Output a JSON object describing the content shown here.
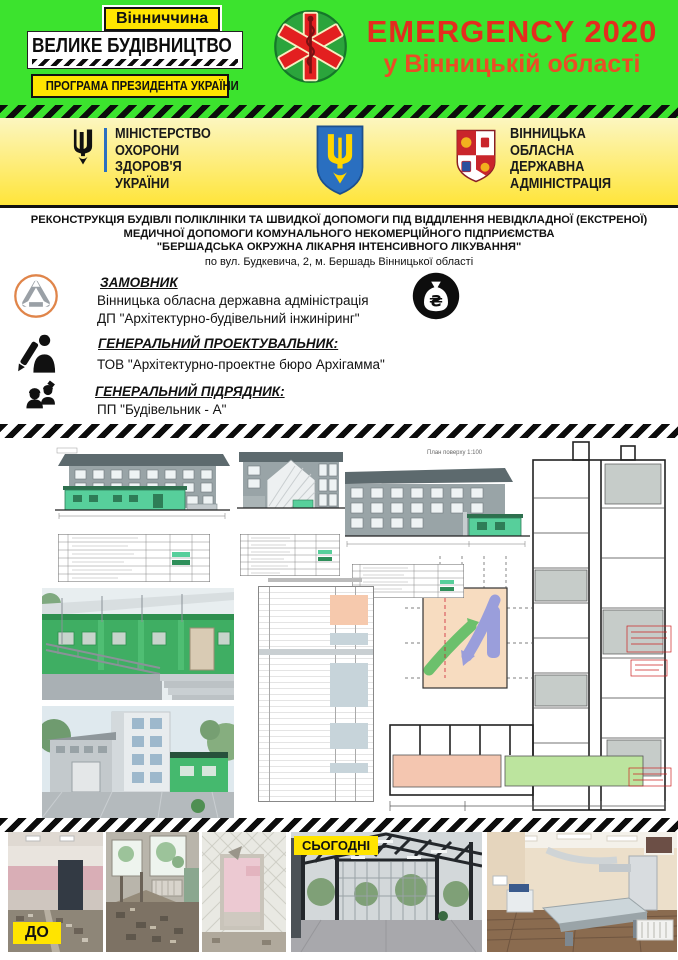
{
  "header": {
    "region_badge": "Вінниччина",
    "program_title": "ВЕЛИКЕ БУДІВНИЦТВО",
    "program_subtitle": "ПРОГРАМА ПРЕЗИДЕНТА УКРАЇНИ",
    "emergency_title": "EMERGENCY 2020",
    "emergency_subtitle": "у Вінницькій області",
    "colors": {
      "bg_green": "#3ce32e",
      "emergency_red": "#e42d1e",
      "badge_yellow": "#ffe400"
    }
  },
  "logos": {
    "moh_lines": [
      "МІНІСТЕРСТВО",
      "ОХОРОНИ",
      "ЗДОРОВ'Я",
      "УКРАЇНИ"
    ],
    "oda_lines": [
      "ВІННИЦЬКА",
      "ОБЛАСНА",
      "ДЕРЖАВНА",
      "АДМІНІСТРАЦІЯ"
    ]
  },
  "project_title": {
    "line1": "РЕКОНСТРУКЦІЯ БУДІВЛІ ПОЛІКЛІНІКИ ТА ШВИДКОЇ ДОПОМОГИ ПІД ВІДДІЛЕННЯ НЕВІДКЛАДНОЇ (ЕКСТРЕНОЇ)",
    "line2": "МЕДИЧНОЇ ДОПОМОГИ КОМУНАЛЬНОГО НЕКОМЕРЦІЙНОГО ПІДПРИЄМСТВА",
    "line3": "\"БЕРШАДСЬКА ОКРУЖНА ЛІКАРНЯ ІНТЕНСИВНОГО ЛІКУВАННЯ\"",
    "line4": "по вул. Будкевича, 2,  м. Бершадь Вінницької області"
  },
  "parties": {
    "customer_label": "ЗАМОВНИК",
    "customer_line1": "Вінницька обласна державна адміністрація",
    "customer_line2": "ДП \"Архітектурно-будівельний інжиніринг\"",
    "designer_label": "ГЕНЕРАЛЬНИЙ ПРОЕКТУВАЛЬНИК:",
    "designer_line": "ТОВ \"Архітектурно-проектне бюро Архігамма\"",
    "contractor_label": "ГЕНЕРАЛЬНИЙ  ПІДРЯДНИК:",
    "contractor_line": "ПП \"Будівельник - А\""
  },
  "budget": {
    "total_label": "Загальна кошторисна вартість:",
    "total_value": "35 994,527 тис.грн",
    "state_label": "Державний бюджет:",
    "state_value": "8 368,89 тис.грн",
    "local_label": "Місцевий бюджет:",
    "local_value": "6 136,996 тис.грн",
    "stage1": "І черга - 13 523,614 тис.грн",
    "stage2": "ІІ черга - 22 470,913 тис.грн"
  },
  "drawings": {
    "plan_title": "План поверху 1:100"
  },
  "photos": {
    "before_label": "ДО",
    "today_label": "СЬОГОДНІ"
  },
  "icons": {
    "emblem": "star-of-life-icon",
    "customer": "recycle-triangle-icon",
    "designer": "architect-pencil-icon",
    "contractor": "builders-icon",
    "budget": "money-bag-icon"
  }
}
